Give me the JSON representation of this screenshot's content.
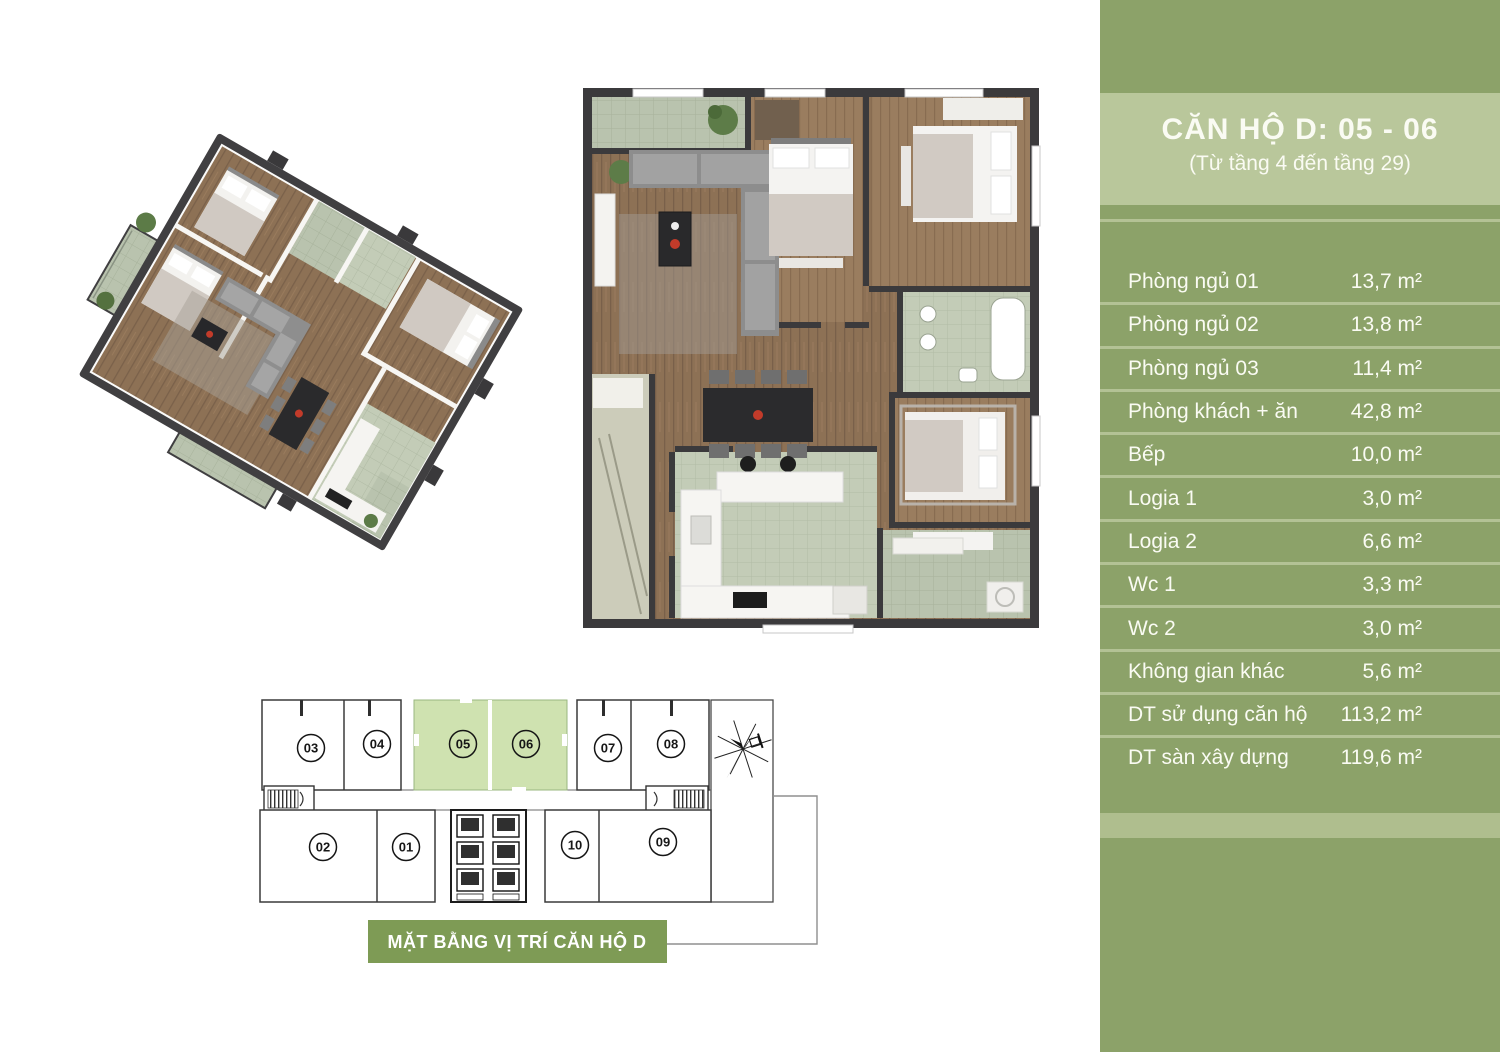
{
  "sidebar": {
    "title": "CĂN HỘ D: 05 - 06",
    "subtitle": "(Từ tầng 4 đến tầng 29)",
    "rows": [
      {
        "label": "Phòng ngủ 01",
        "value": "13,7 m²"
      },
      {
        "label": "Phòng ngủ 02",
        "value": "13,8 m²"
      },
      {
        "label": "Phòng ngủ 03",
        "value": "11,4 m²"
      },
      {
        "label": "Phòng khách + ăn",
        "value": "42,8 m²"
      },
      {
        "label": "Bếp",
        "value": "10,0 m²"
      },
      {
        "label": "Logia 1",
        "value": "3,0 m²"
      },
      {
        "label": "Logia 2",
        "value": "6,6 m²"
      },
      {
        "label": "Wc 1",
        "value": "3,3 m²"
      },
      {
        "label": "Wc 2",
        "value": "3,0 m²"
      },
      {
        "label": "Không gian khác",
        "value": "5,6 m²"
      },
      {
        "label": "DT sử dụng căn hộ",
        "value": "113,2 m²"
      },
      {
        "label": "DT sàn xây dựng",
        "value": "119,6 m²"
      }
    ],
    "colors": {
      "panel_green": "#8CA269",
      "header_green": "#B9C79B",
      "divider_green": "#B4C295",
      "stripe_green": "#AFBE8E",
      "text": "#FAFBF3"
    }
  },
  "floor_layout": {
    "banner": "MẶT BẰNG VỊ TRÍ CĂN HỘ D",
    "highlighted_units": [
      "05",
      "06"
    ],
    "units": [
      {
        "label": "03"
      },
      {
        "label": "04"
      },
      {
        "label": "05"
      },
      {
        "label": "06"
      },
      {
        "label": "07"
      },
      {
        "label": "08"
      },
      {
        "label": "02"
      },
      {
        "label": "01"
      },
      {
        "label": "10"
      },
      {
        "label": "09"
      }
    ],
    "colors": {
      "highlight_green": "#CFE2B0",
      "banner_green": "#7E9B55"
    }
  }
}
